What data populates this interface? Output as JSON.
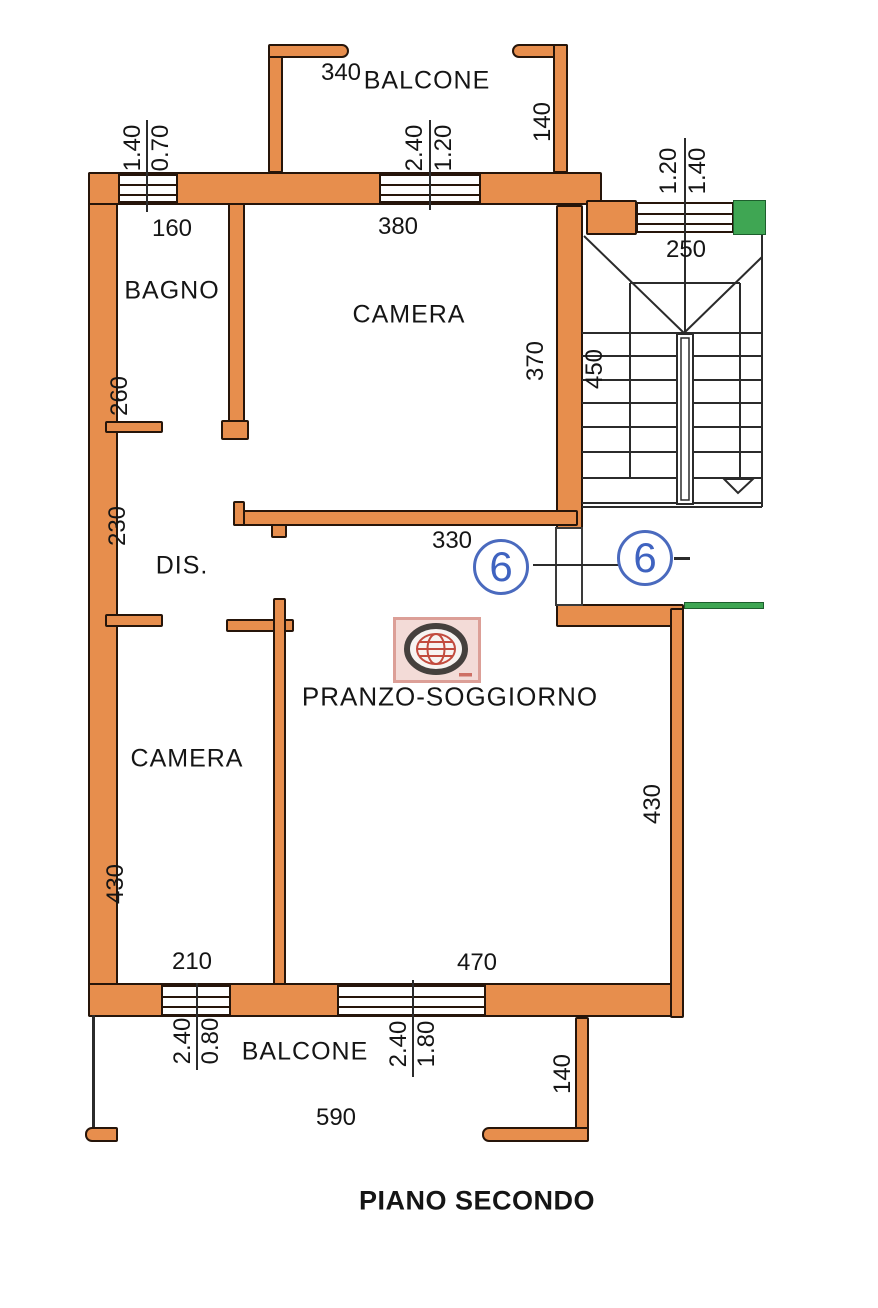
{
  "title": "PIANO SECONDO",
  "rooms": {
    "bagno": "BAGNO",
    "camera_top": "CAMERA",
    "dis": "DIS.",
    "camera_bottom": "CAMERA",
    "pranzo": "PRANZO-SOGGIORNO",
    "balcone_top": "BALCONE",
    "balcone_bottom": "BALCONE"
  },
  "dims": {
    "balcone_top_width": "340",
    "balcone_top_depth": "140",
    "bagno_width": "160",
    "bagno_window": [
      "1.40",
      "0.70"
    ],
    "camera_top_width": "380",
    "camera_top_window": [
      "2.40",
      "1.20"
    ],
    "stair_window": [
      "1.20",
      "1.40"
    ],
    "stair_width": "250",
    "stair_depth": "450",
    "bagno_depth": "260",
    "dis_depth": "230",
    "camera_top_depth": "370",
    "entry_span": "330",
    "camera_bottom_depth": "430",
    "pranzo_depth": "430",
    "camera_bottom_width": "210",
    "pranzo_width": "470",
    "camera_bottom_window": [
      "2.40",
      "0.80"
    ],
    "pranzo_window": [
      "2.40",
      "1.80"
    ],
    "balcone_bottom_depth": "140",
    "balcone_bottom_width": "590"
  },
  "markers": {
    "unit_left": "6",
    "unit_right": "6"
  },
  "colors": {
    "wall_fill": "#e78e4d",
    "neighbor_green": "#3fa653",
    "marker_blue": "#4a6abe",
    "logo_red": "#c24b3e"
  }
}
